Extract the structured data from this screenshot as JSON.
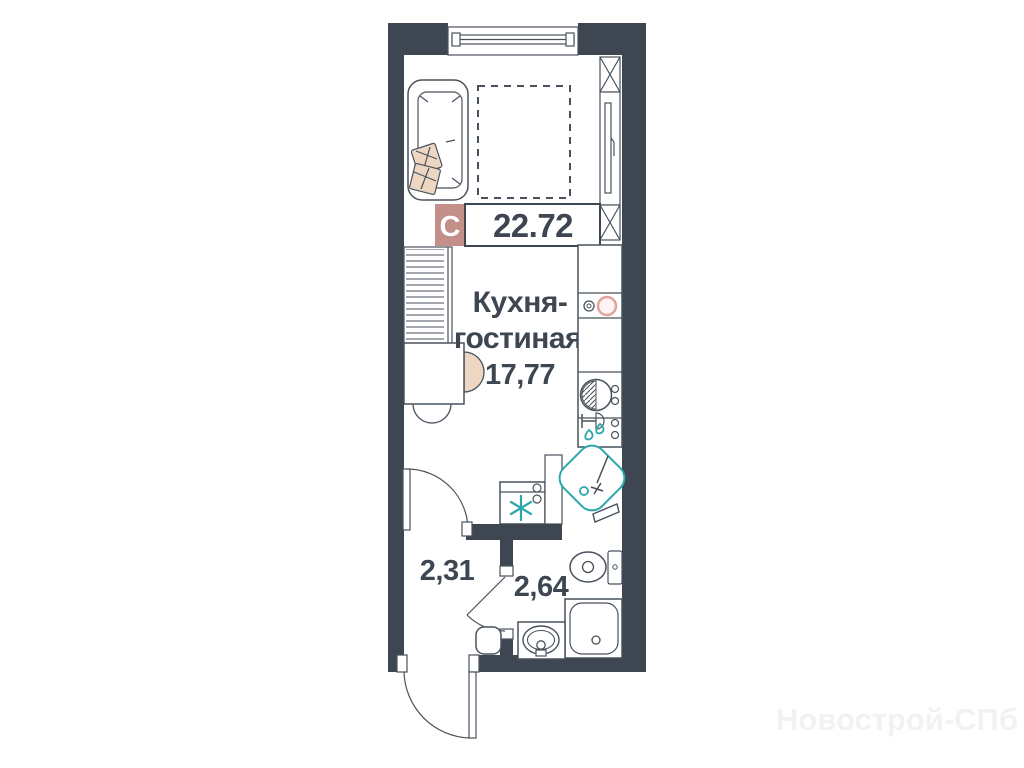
{
  "badge": {
    "type": "С",
    "area": "22.72"
  },
  "rooms": {
    "kitchen_living": {
      "name_line1": "Кухня-",
      "name_line2": "гостиная",
      "area": "17,77"
    },
    "hallway": {
      "area": "2,31"
    },
    "bathroom": {
      "area": "2,64"
    }
  },
  "watermark": {
    "text": "Новострой-СПб"
  },
  "colors": {
    "wall": "#3e4751",
    "line": "#49525c",
    "accent_teal": "#2ba8ac",
    "badge_rose": "#c38f89",
    "beige": "#eed7c2",
    "beige_line": "#b99a80",
    "burner_pink": "#e2a29d",
    "watermark": "#f2f2f2"
  }
}
